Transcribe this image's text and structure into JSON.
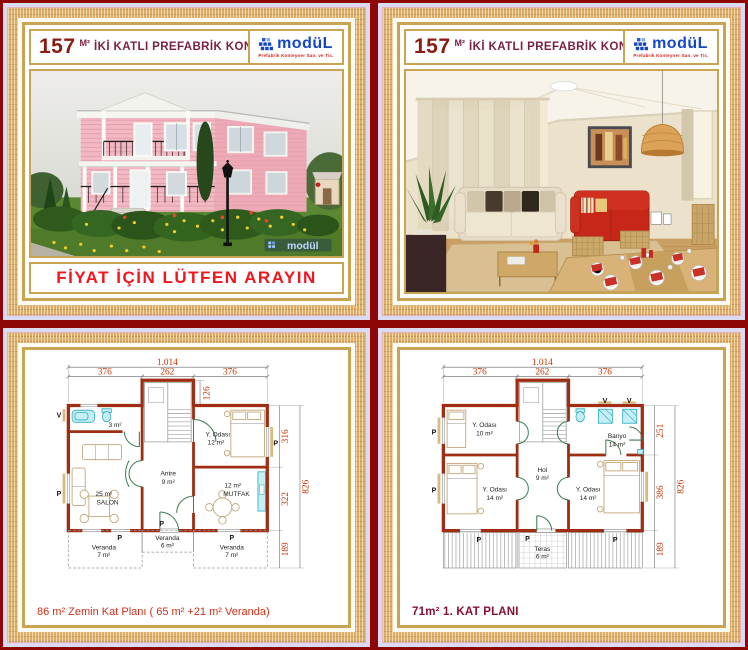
{
  "colors": {
    "frame_red": "#8e0606",
    "gold_border": "#c9a453",
    "wall_red": "#9e2d12",
    "dim_orange": "#cc3300",
    "logo_blue": "#1646c8",
    "price_red": "#f3151d"
  },
  "header": {
    "area": "157",
    "area_unit": "M²",
    "title": "İKİ KATLI PREFABRİK KONUT"
  },
  "brand": {
    "logo_text": "modüL",
    "logo_tagline": "Prefabrik Konteyner San. ve Tic."
  },
  "top_left": {
    "price_text": "FİYAT İÇİN LÜTFEN ARAYIN",
    "watermark": "modül"
  },
  "plan_ground": {
    "caption": "86 m² Zemin Kat Planı ( 65 m² +21 m² Veranda)",
    "dims": {
      "total_w": "1.014",
      "w_left": "376",
      "w_mid": "262",
      "w_right": "376",
      "stair": "126",
      "upper": "316",
      "lower": "322",
      "veranda": "189",
      "total_h": "826"
    },
    "rooms": {
      "wc_area": "3 m²",
      "salon_area": "25 m²",
      "salon_name": "SALON",
      "antre_name": "Antre",
      "antre_area": "9 m²",
      "bed_name": "Y. Odası",
      "bed_area": "12 m²",
      "kitchen_area": "12 m²",
      "kitchen_name": "MUTFAK",
      "veranda_mid_name": "Veranda",
      "veranda_mid_area": "6 m²",
      "veranda_left_name": "Veranda",
      "veranda_left_area": "7 m²",
      "veranda_right_name": "Veranda",
      "veranda_right_area": "7 m²"
    },
    "marks": {
      "p": "P",
      "v": "V"
    }
  },
  "plan_first": {
    "caption": "71m² 1. KAT PLANI",
    "dims": {
      "total_w": "1.014",
      "w_left": "376",
      "w_mid": "262",
      "w_right": "376",
      "upper": "251",
      "mid": "386",
      "veranda": "189",
      "total_h": "826"
    },
    "rooms": {
      "bed1_name": "Y. Odası",
      "bed1_area": "10 m²",
      "bath_name": "Banyo",
      "bath_area": "14 m²",
      "hall_name": "Hol",
      "hall_area": "9 m²",
      "bed2_name": "Y. Odası",
      "bed2_area": "14 m²",
      "bed3_name": "Y. Odası",
      "bed3_area": "14 m²",
      "teras_name": "Teras",
      "teras_area": "6 m²"
    },
    "marks": {
      "p": "P",
      "v": "V"
    }
  }
}
